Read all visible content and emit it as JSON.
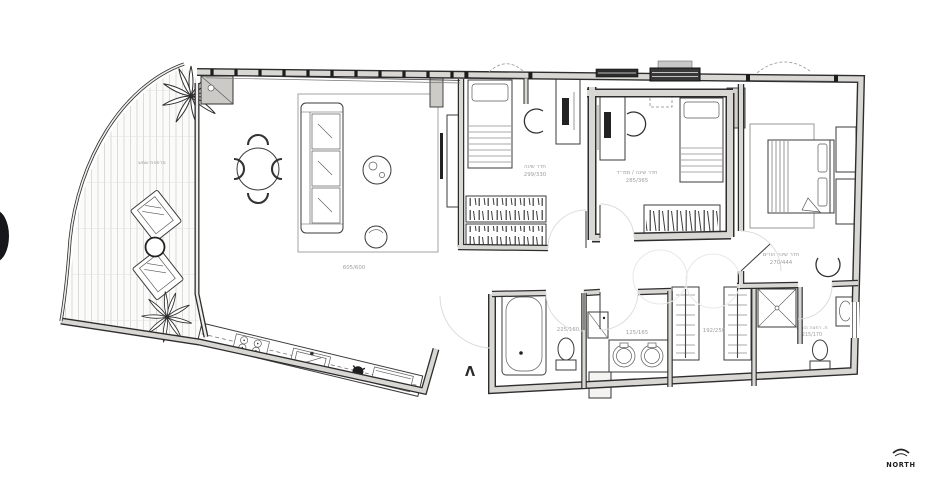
{
  "compass": {
    "label": "NORTH"
  },
  "entry": {
    "symbol": "Λ"
  },
  "rooms": {
    "terrace": {
      "label": "מרפסת שמש"
    },
    "living_room": {
      "dims": "605/600"
    },
    "bedroom_1": {
      "label": "חדר שינה",
      "dims": "299/330"
    },
    "bedroom_2": {
      "label": "חדר שינה / ממ״ד",
      "dims": "285/365"
    },
    "master_bedroom": {
      "label": "חדר שינה הורים",
      "dims": "270/444"
    },
    "bathroom": {
      "dims": "225/160"
    },
    "laundry": {
      "dims": "125/165"
    },
    "walk_in_closet": {
      "dims": "192/250"
    },
    "master_bathroom": {
      "label": "ח. רחצה הורים",
      "dims": "215/170"
    }
  },
  "colors": {
    "wall_fill": "#d8d7d3",
    "wall_edge": "#2d2d2d",
    "label_text": "#9e9e9e",
    "edge_marker": "#17171b"
  }
}
